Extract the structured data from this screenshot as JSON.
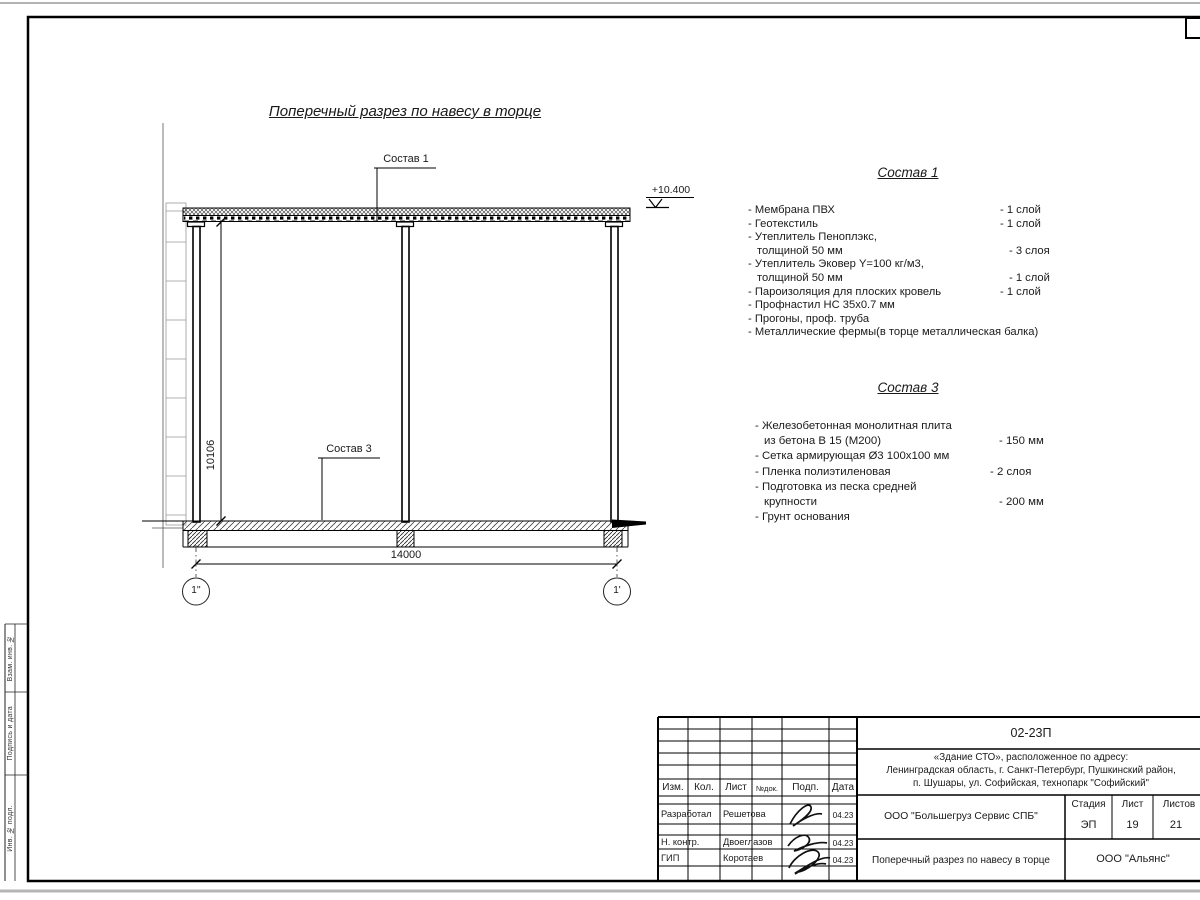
{
  "drawing": {
    "title": "Поперечный разрез по навесу в торце",
    "callout1": "Состав 1",
    "callout3": "Состав 3",
    "elevation": "+10.400",
    "dim_height": "10106",
    "dim_width": "14000",
    "axis_left": "1''",
    "axis_right": "1'"
  },
  "sostav1": {
    "heading": "Состав 1",
    "rows": [
      {
        "text": "- Мембрана ПВХ",
        "qty": "- 1 слой"
      },
      {
        "text": "- Геотекстиль",
        "qty": "- 1 слой"
      },
      {
        "text": "- Утеплитель Пеноплэкс,",
        "qty": ""
      },
      {
        "text": "толщиной 50 мм",
        "qty": "- 3 слоя"
      },
      {
        "text": "- Утеплитель Эковер Y=100 кг/м3,",
        "qty": ""
      },
      {
        "text": "толщиной 50 мм",
        "qty": "- 1 слой"
      },
      {
        "text": "- Пароизоляция для плоских кровель",
        "qty": "- 1 слой"
      },
      {
        "text": "- Профнастил НС 35х0.7 мм",
        "qty": ""
      },
      {
        "text": "- Прогоны, проф. труба",
        "qty": ""
      },
      {
        "text": "- Металлические фермы(в торце металлическая балка)",
        "qty": ""
      }
    ]
  },
  "sostav3": {
    "heading": "Состав 3",
    "rows": [
      {
        "text": "- Железобетонная  монолитная плита",
        "qty": ""
      },
      {
        "text": "из бетона В 15 (М200)",
        "qty": "- 150 мм"
      },
      {
        "text": "- Сетка армирующая Ø3 100х100 мм",
        "qty": ""
      },
      {
        "text": "- Пленка полиэтиленовая",
        "qty": "-  2 слоя"
      },
      {
        "text": "- Подготовка из песка средней",
        "qty": ""
      },
      {
        "text": "крупности",
        "qty": "- 200 мм"
      },
      {
        "text": "- Грунт основания",
        "qty": ""
      }
    ]
  },
  "titleblock": {
    "doc_number": "02-23П",
    "object_line1": "«Здание СТО», расположенное по адресу:",
    "object_line2": "Ленинградская область, г. Санкт-Петербург, Пушкинский район,",
    "object_line3": "п. Шушары, ул. Софийская, технопарк \"Софийский\"",
    "header_cols": [
      "Изм.",
      "Кол.",
      "Лист",
      "№док.",
      "Подп.",
      "Дата"
    ],
    "roles": [
      {
        "role": "Разработал",
        "name": "Решетова",
        "date": "04.23"
      },
      {
        "role": "Н. контр.",
        "name": "Двоеглазов",
        "date": "04.23"
      },
      {
        "role": "ГИП",
        "name": "Коротаев",
        "date": "04.23"
      }
    ],
    "company": "ООО \"Большегруз Сервис СПБ\"",
    "stage_label": "Стадия",
    "sheet_label": "Лист",
    "sheets_label": "Листов",
    "stage": "ЭП",
    "sheet": "19",
    "sheets": "21",
    "sheet_title": "Поперечный разрез по навесу в торце",
    "org": "ООО \"Альянс\""
  },
  "side_strip": {
    "cells": [
      "Взам. инв. №",
      "Подпись и дата",
      "Инв. № подл."
    ]
  },
  "colors": {
    "line": "#000000",
    "gray_line": "#999999",
    "paper_edge": "#b5b5b5"
  }
}
